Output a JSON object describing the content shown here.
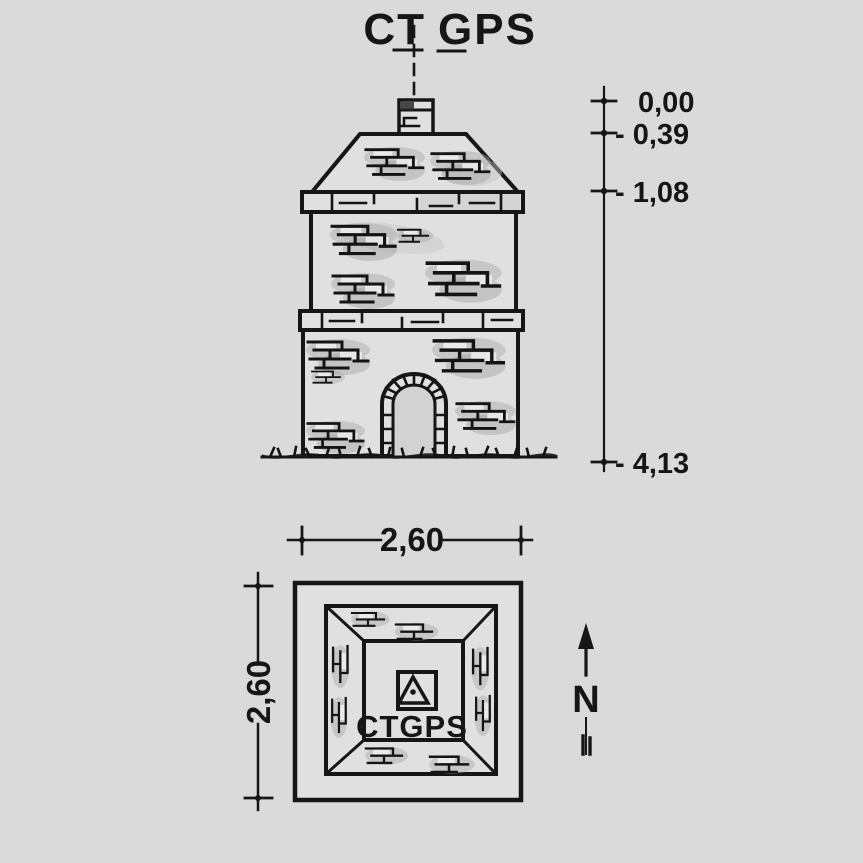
{
  "colors": {
    "paper": "#dadada",
    "ink": "#161616",
    "brick_shade": "#a8a8a8"
  },
  "station": {
    "title_left": "CT",
    "title_right": "GPS",
    "plan_marker_label": "CTGPS",
    "north_label": "N"
  },
  "elevation": {
    "levels": [
      {
        "label": "0,00"
      },
      {
        "label": "- 0,39"
      },
      {
        "label": "- 1,08"
      },
      {
        "label": "- 4,13"
      }
    ]
  },
  "plan": {
    "width_label": "2,60",
    "depth_label": "2,60"
  }
}
